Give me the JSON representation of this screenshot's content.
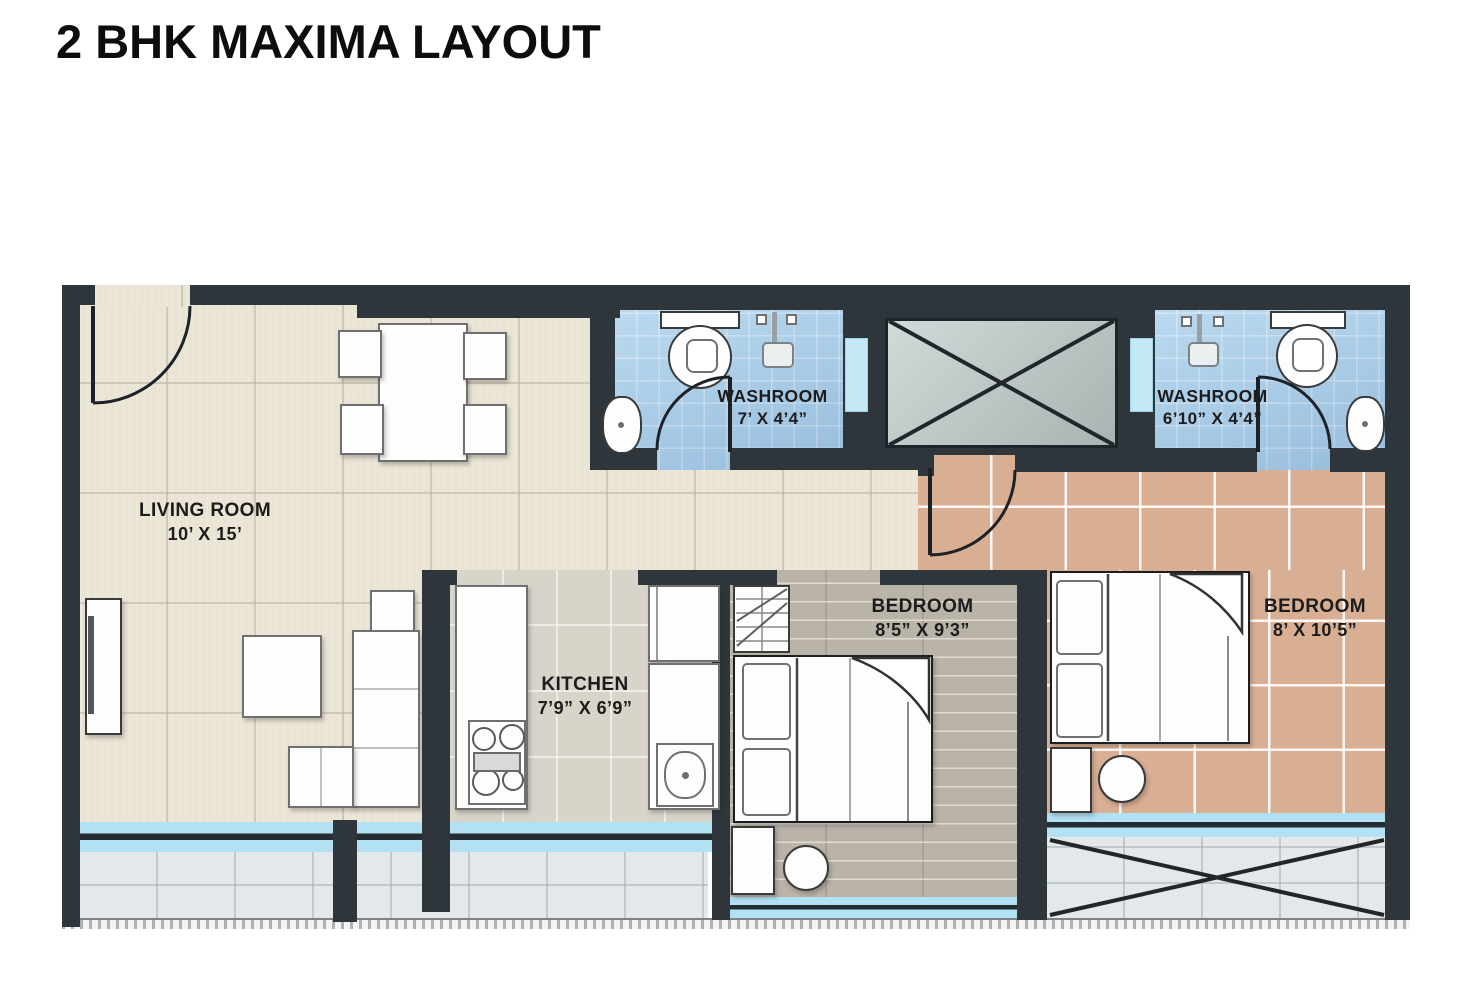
{
  "title": "2 BHK MAXIMA LAYOUT",
  "rooms": {
    "living": {
      "name": "LIVING ROOM",
      "dims": "10’ X 15’"
    },
    "kitchen": {
      "name": "KITCHEN",
      "dims": "7’9” X 6’9”"
    },
    "washroom1": {
      "name": "WASHROOM",
      "dims": "7’ X 4’4”"
    },
    "washroom2": {
      "name": "WASHROOM",
      "dims": "6’10” X 4’4”"
    },
    "bedroom1": {
      "name": "BEDROOM",
      "dims": "8’5” X 9’3”"
    },
    "bedroom2": {
      "name": "BEDROOM",
      "dims": "8’ X 10’5”"
    }
  },
  "furniture": [
    "dining-table",
    "dining-chairs",
    "l-sofa",
    "coffee-table",
    "tv-unit",
    "side-table",
    "stove",
    "kitchen-sink",
    "fridge",
    "toilet",
    "shower",
    "washbasin",
    "double-bed",
    "pillows",
    "nightstand",
    "stool",
    "dresser",
    "duct-shaft",
    "deck"
  ],
  "colors": {
    "wall": "#2e363c",
    "living_floor": "#eae4d4",
    "kitchen_floor": "#d8d4ca",
    "washroom_floor": "#a4cdea",
    "bedroom1_floor": "#b9b3a8",
    "bedroom2_floor": "#d9af94",
    "window_glass": "#b2e1f3",
    "deck_floor": "#e3e8ea",
    "duct": "#c0c9c8"
  }
}
